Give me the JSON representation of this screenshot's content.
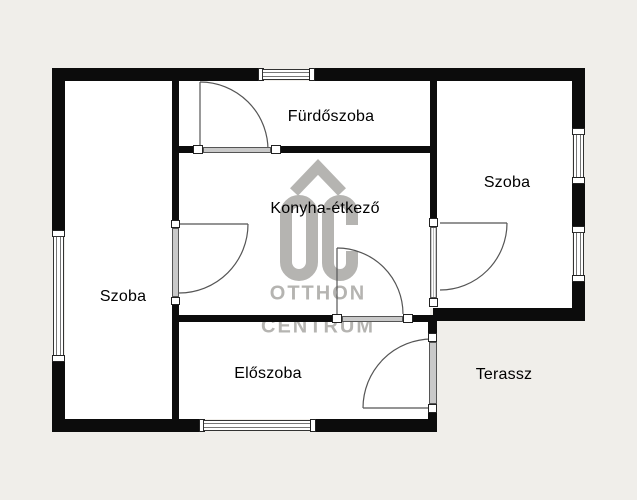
{
  "plan_title": "floor-plan",
  "rooms": [
    {
      "id": "furdoszoba",
      "label": "Fürdőszoba"
    },
    {
      "id": "szoba-right",
      "label": "Szoba"
    },
    {
      "id": "konyha-etkezo",
      "label": "Konyha-étkező"
    },
    {
      "id": "szoba-left",
      "label": "Szoba"
    },
    {
      "id": "eloszoba",
      "label": "Előszoba"
    },
    {
      "id": "terassz",
      "label": "Terassz"
    }
  ],
  "watermark": {
    "logo": "OC-house-logo",
    "line1": "OTTHON",
    "line2": "CENTRUM"
  },
  "colors": {
    "background": "#f0eeea",
    "room_fill": "#ffffff",
    "wall": "#0c0c0c",
    "door_fill": "#c9c9c9",
    "watermark_gray": "#b5b4b1"
  }
}
